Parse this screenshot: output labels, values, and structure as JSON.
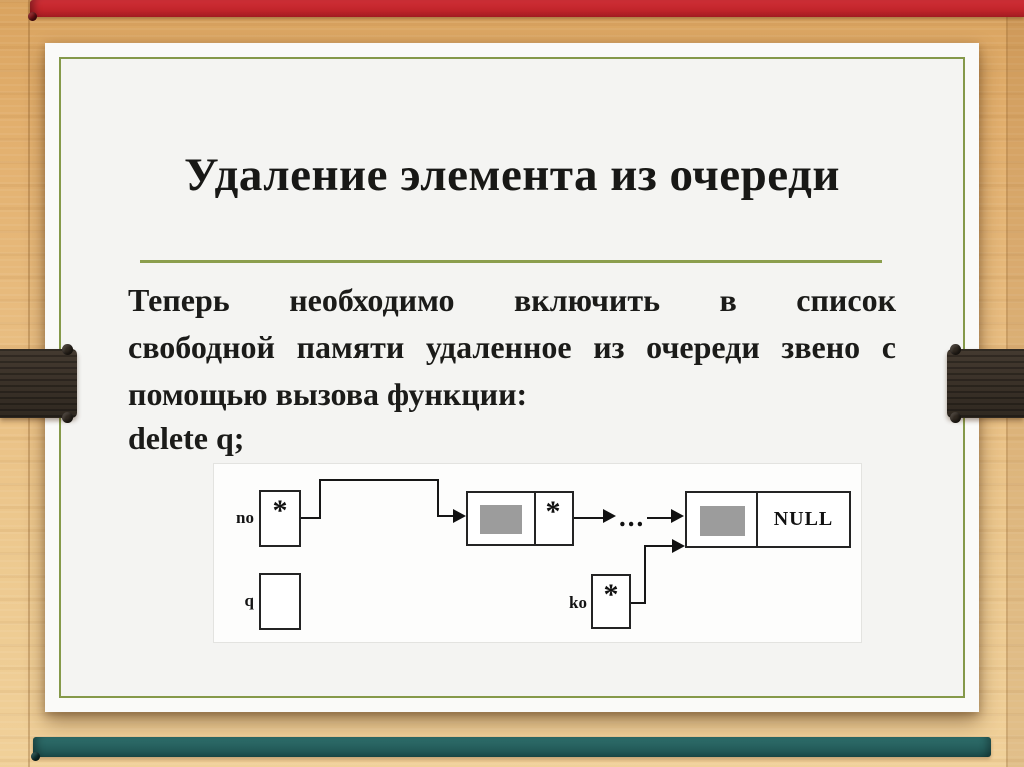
{
  "slide": {
    "title": "Удаление элемента из очереди",
    "body_lines": [
      "Теперь необходимо включить в список",
      "свободной памяти удаленное из очереди звено с",
      "помощью вызова функции:"
    ],
    "code_line": "delete q;"
  },
  "diagram": {
    "head_label": "no",
    "free_label": "q",
    "tail_label": "ko",
    "null_label": "NULL",
    "pointer_symbol": "*",
    "ellipsis": "..."
  },
  "colors": {
    "ribbon_red": "#c2252b",
    "ribbon_teal": "#255e5c",
    "ribbon_dark": "#3a3128",
    "accent_green": "#85994a",
    "wood": "#e8bc7f",
    "paper": "#f4f4f2"
  }
}
